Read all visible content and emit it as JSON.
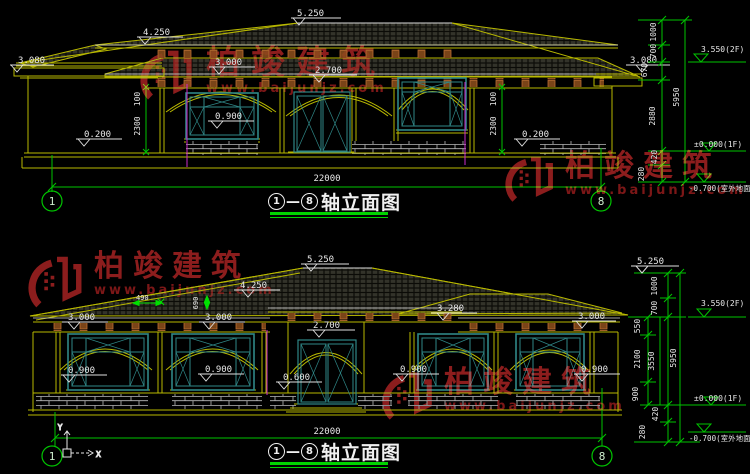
{
  "colors": {
    "background": "#000000",
    "line_yellow": "#b9b900",
    "dim_green": "#00c400",
    "frame_teal": "#2f8787",
    "magenta": "#cc2bcc",
    "watermark_red": "#8c1d1d",
    "text_white": "#e8e8e8"
  },
  "watermark": {
    "brand": "柏竣建筑",
    "url": "www.baijunjz.com"
  },
  "titles": {
    "top": {
      "from": "1",
      "sep": "—",
      "to": "8",
      "label": "轴立面图"
    },
    "bottom": {
      "from": "1",
      "sep": "—",
      "to": "8",
      "label": "轴立面图"
    }
  },
  "ucs": {
    "x": "X",
    "y": "Y"
  },
  "top": {
    "axisL": "1",
    "axisR": "8",
    "width": "22000",
    "marks": {
      "ridge": "5.250",
      "slope": "4.250",
      "eaveL": "3.080",
      "arch": "3.000",
      "door": "2.700",
      "sill": "0.900",
      "plinthL": "0.200",
      "plinthR": "0.200",
      "eaveR": "3.080"
    },
    "v1": {
      "a": "100",
      "b": "2300"
    },
    "v2": {
      "a": "100",
      "b": "2300"
    },
    "chain": {
      "s1": "1000",
      "s2": "700",
      "s3": "670",
      "s4": "2880",
      "s5": "420",
      "s6": "280",
      "total": "5950"
    },
    "levels": {
      "f2": "3.550(2F)",
      "f1": "±0.000(1F)",
      "gnd": "-0.700(室外地面)"
    }
  },
  "bottom": {
    "axisL": "1",
    "axisR": "8",
    "width": "22000",
    "marks": {
      "ridge": "5.250",
      "slope": "4.250",
      "d490": "490",
      "d690": "690",
      "eave1": "3.000",
      "eave2": "3.000",
      "eave3": "3.280",
      "eave4": "3.000",
      "door": "2.700",
      "doorSill": "0.600",
      "sill1": "0.900",
      "sill2": "0.900",
      "sill3": "0.900",
      "sill4": "0.900"
    },
    "chain": {
      "top": "5.250",
      "s1": "1000",
      "s2": "700",
      "s3": "550",
      "s4": "2100",
      "s5": "900",
      "s6": "420",
      "s7": "280",
      "mid": "3550",
      "total": "5950"
    },
    "levels": {
      "f2": "3.550(2F)",
      "f1": "±0.000(1F)",
      "gnd": "-0.700(室外地面)"
    }
  }
}
